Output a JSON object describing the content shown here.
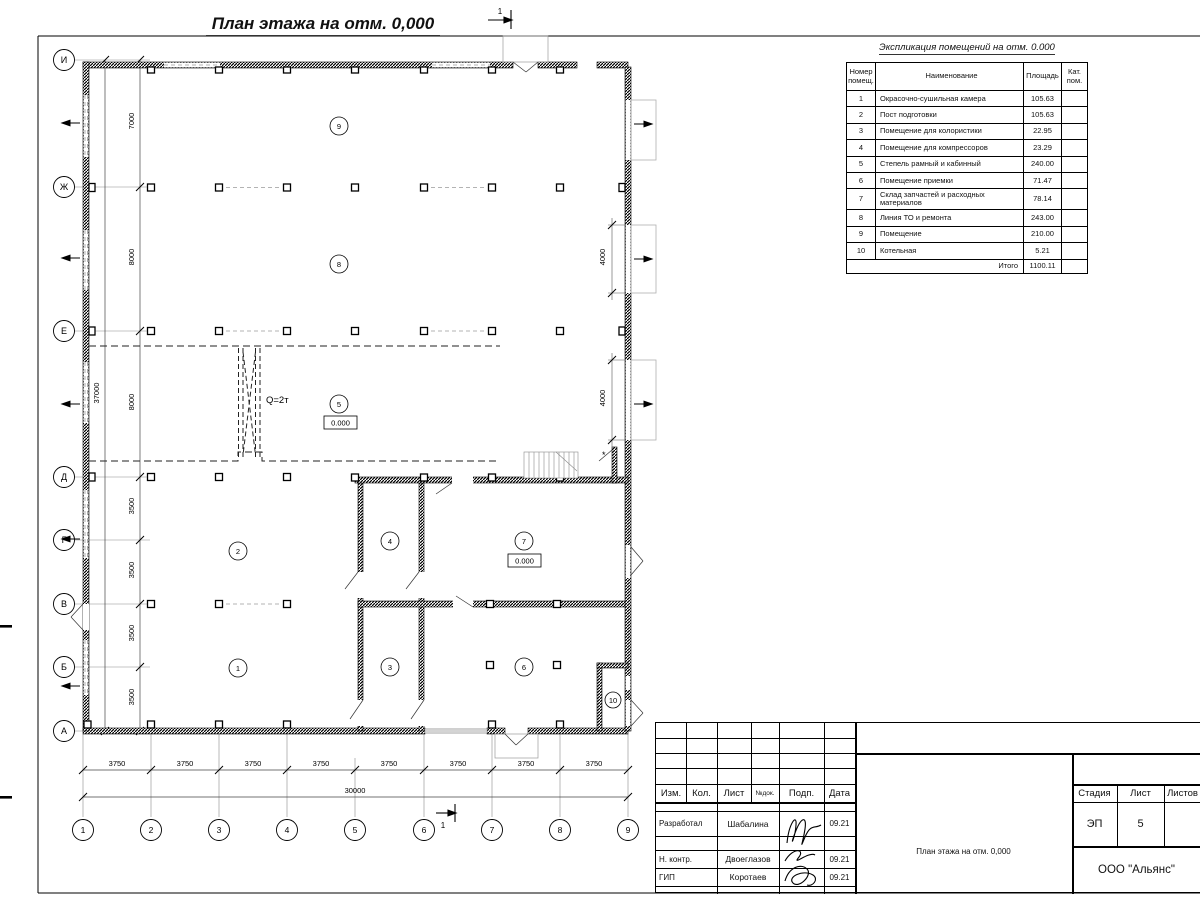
{
  "sheet": {
    "title": "План этажа на отм. 0,000"
  },
  "expl": {
    "title": "Экспликация помещений на отм. 0.000",
    "head": {
      "num": "Номер помещ.",
      "name": "Наименование",
      "area": "Площадь",
      "cat": "Кат. пом."
    },
    "rows": [
      {
        "num": "1",
        "name": "Окрасочно-сушильная камера",
        "area": "105.63"
      },
      {
        "num": "2",
        "name": "Пост подготовки",
        "area": "105.63"
      },
      {
        "num": "3",
        "name": "Помещение для колористики",
        "area": "22.95"
      },
      {
        "num": "4",
        "name": "Помещение для компрессоров",
        "area": "23.29"
      },
      {
        "num": "5",
        "name": "Степель рамный и кабинный",
        "area": "240.00"
      },
      {
        "num": "6",
        "name": "Помещение приемки",
        "area": "71.47"
      },
      {
        "num": "7",
        "name": "Склад запчастей и расходных материалов",
        "area": "78.14"
      },
      {
        "num": "8",
        "name": "Линия ТО и ремонта",
        "area": "243.00"
      },
      {
        "num": "9",
        "name": "Помещение",
        "area": "210.00"
      },
      {
        "num": "10",
        "name": "Котельная",
        "area": "5.21"
      }
    ],
    "total_label": "Итого",
    "total": "1100.11"
  },
  "titleblock": {
    "izm": "Изм.",
    "kol": "Кол.",
    "list": "Лист",
    "ndok": "№док.",
    "podp": "Подп.",
    "data": "Дата",
    "rows": [
      {
        "role": "Разработал",
        "name": "Шабалина",
        "date": "09.21"
      },
      {
        "role": "Н. контр.",
        "name": "Двоеглазов",
        "date": "09.21"
      },
      {
        "role": "ГИП",
        "name": "Коротаев",
        "date": "09.21"
      }
    ],
    "stage_label": "Стадия",
    "sheet_label": "Лист",
    "sheets_label": "Листов",
    "stage": "ЭП",
    "sheet_num": "5",
    "doc_title": "План этажа на отм. 0,000",
    "company": "ООО \"Альянс\""
  },
  "axes": {
    "rows": [
      "И",
      "Ж",
      "Е",
      "Д",
      "Г",
      "В",
      "Б",
      "А"
    ],
    "cols": [
      "1",
      "2",
      "3",
      "4",
      "5",
      "6",
      "7",
      "8",
      "9"
    ]
  },
  "dims": {
    "v": [
      "7000",
      "8000",
      "8000",
      "3500",
      "3500",
      "3500",
      "3500"
    ],
    "v_total": "37000",
    "h3750": "3750",
    "h_total": "30000",
    "gate": "4000"
  },
  "plan": {
    "rooms": [
      "1",
      "2",
      "3",
      "4",
      "5",
      "6",
      "7",
      "8",
      "9",
      "10"
    ],
    "elev": "0.000",
    "crane": "Q=2т",
    "section": "1",
    "star": "*"
  },
  "colors": {
    "ink": "#1a1a1a",
    "light": "#9a9a9a"
  }
}
